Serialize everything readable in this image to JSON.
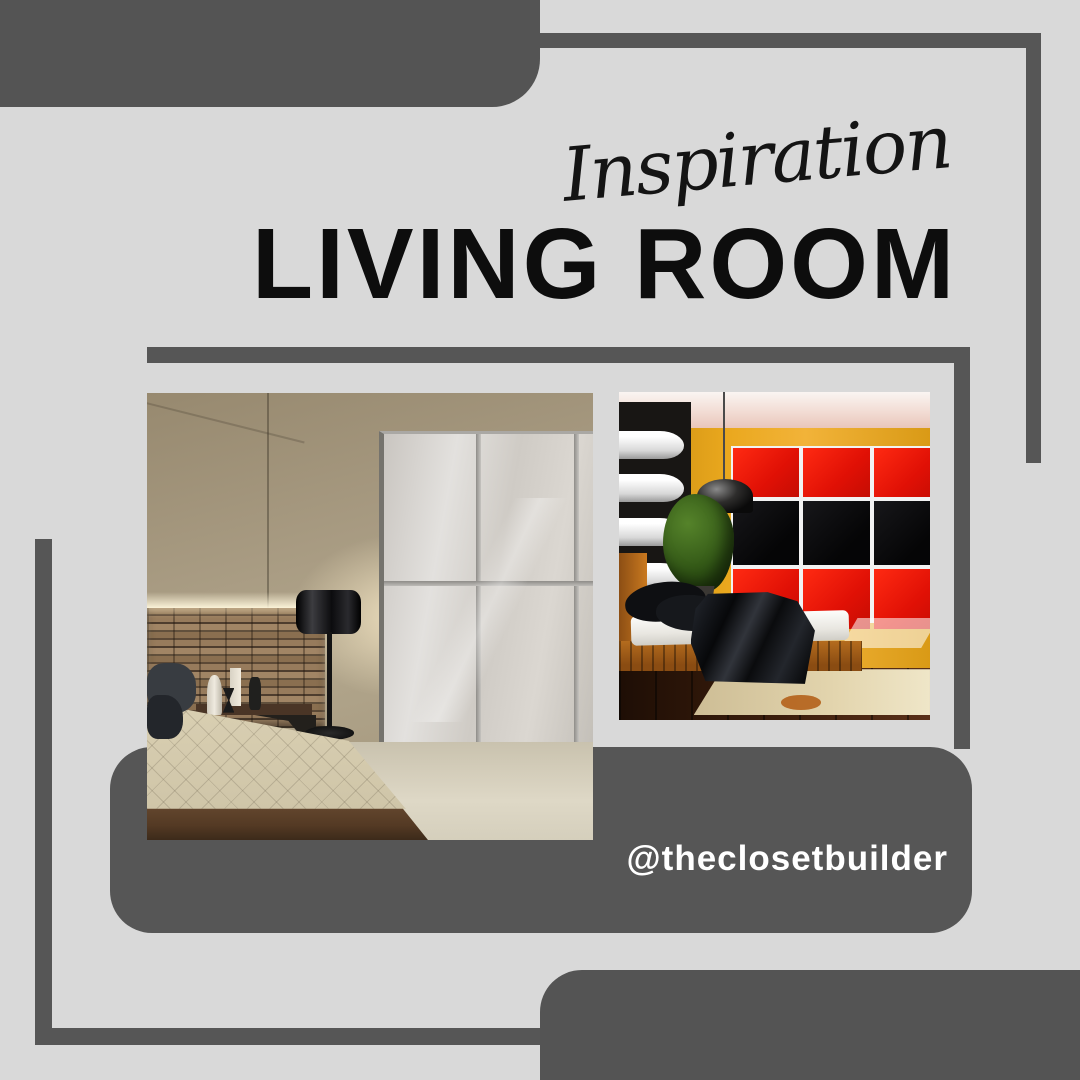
{
  "poster": {
    "script_title": "Inspiration",
    "main_title": "LIVING ROOM",
    "handle": "@theclosetbuilder",
    "palette": {
      "background": "#d9d9d9",
      "dark_gray": "#545454",
      "title_black": "#0d0d0d",
      "handle_white": "#ffffff",
      "closet_red": "#e01005",
      "wall_yellow": "#e8a71e"
    },
    "photos": [
      {
        "name": "bedroom-frosted-sliding-closet",
        "alt": "Bedroom with frosted glass sliding closet doors, stacked stone accent wall, black floor lamp and platform bed"
      },
      {
        "name": "bedroom-red-black-closet",
        "alt": "Bedroom with red and black grid closet wall, yellow wall, black shelf wall, pendant lamp, plant and bed with black blanket"
      }
    ]
  }
}
